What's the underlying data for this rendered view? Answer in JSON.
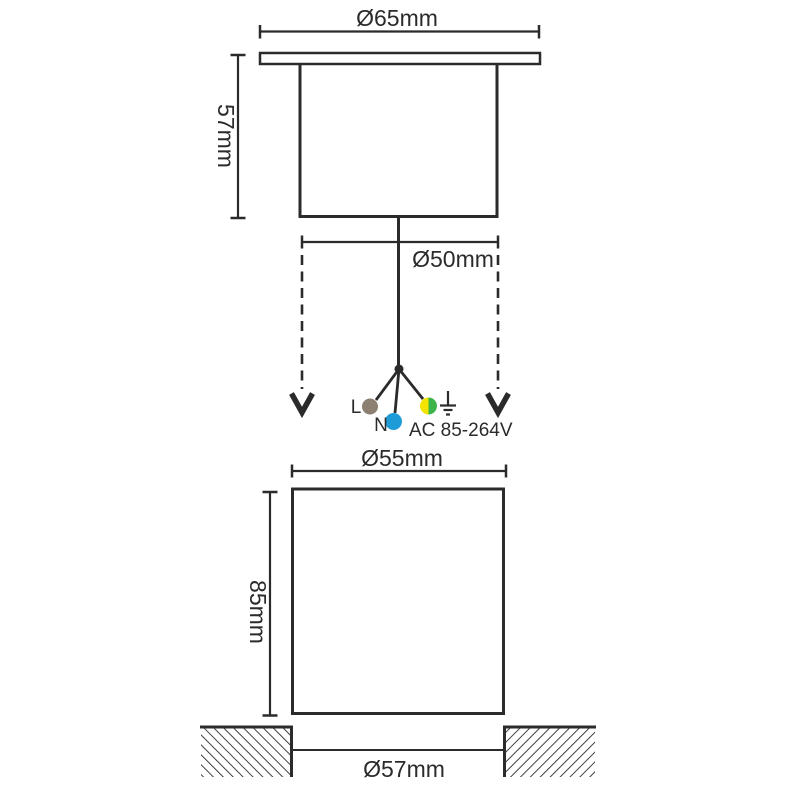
{
  "line_color": "#2B2B2B",
  "top_view": {
    "flange_diameter_label": "Ø65mm",
    "body_height_label": "57mm",
    "body_diameter_label": "Ø50mm"
  },
  "wiring": {
    "live_label": "L",
    "neutral_label": "N",
    "voltage_label": "AC 85-264V",
    "colors": {
      "live_wire": "#8B8072",
      "neutral_wire": "#1E9CD7",
      "earth_yellow": "#F2E300",
      "earth_green": "#3CB44A"
    }
  },
  "bottom_view": {
    "body_width_label": "Ø55mm",
    "body_height_label": "85mm",
    "cutout_diameter_label": "Ø57mm"
  }
}
